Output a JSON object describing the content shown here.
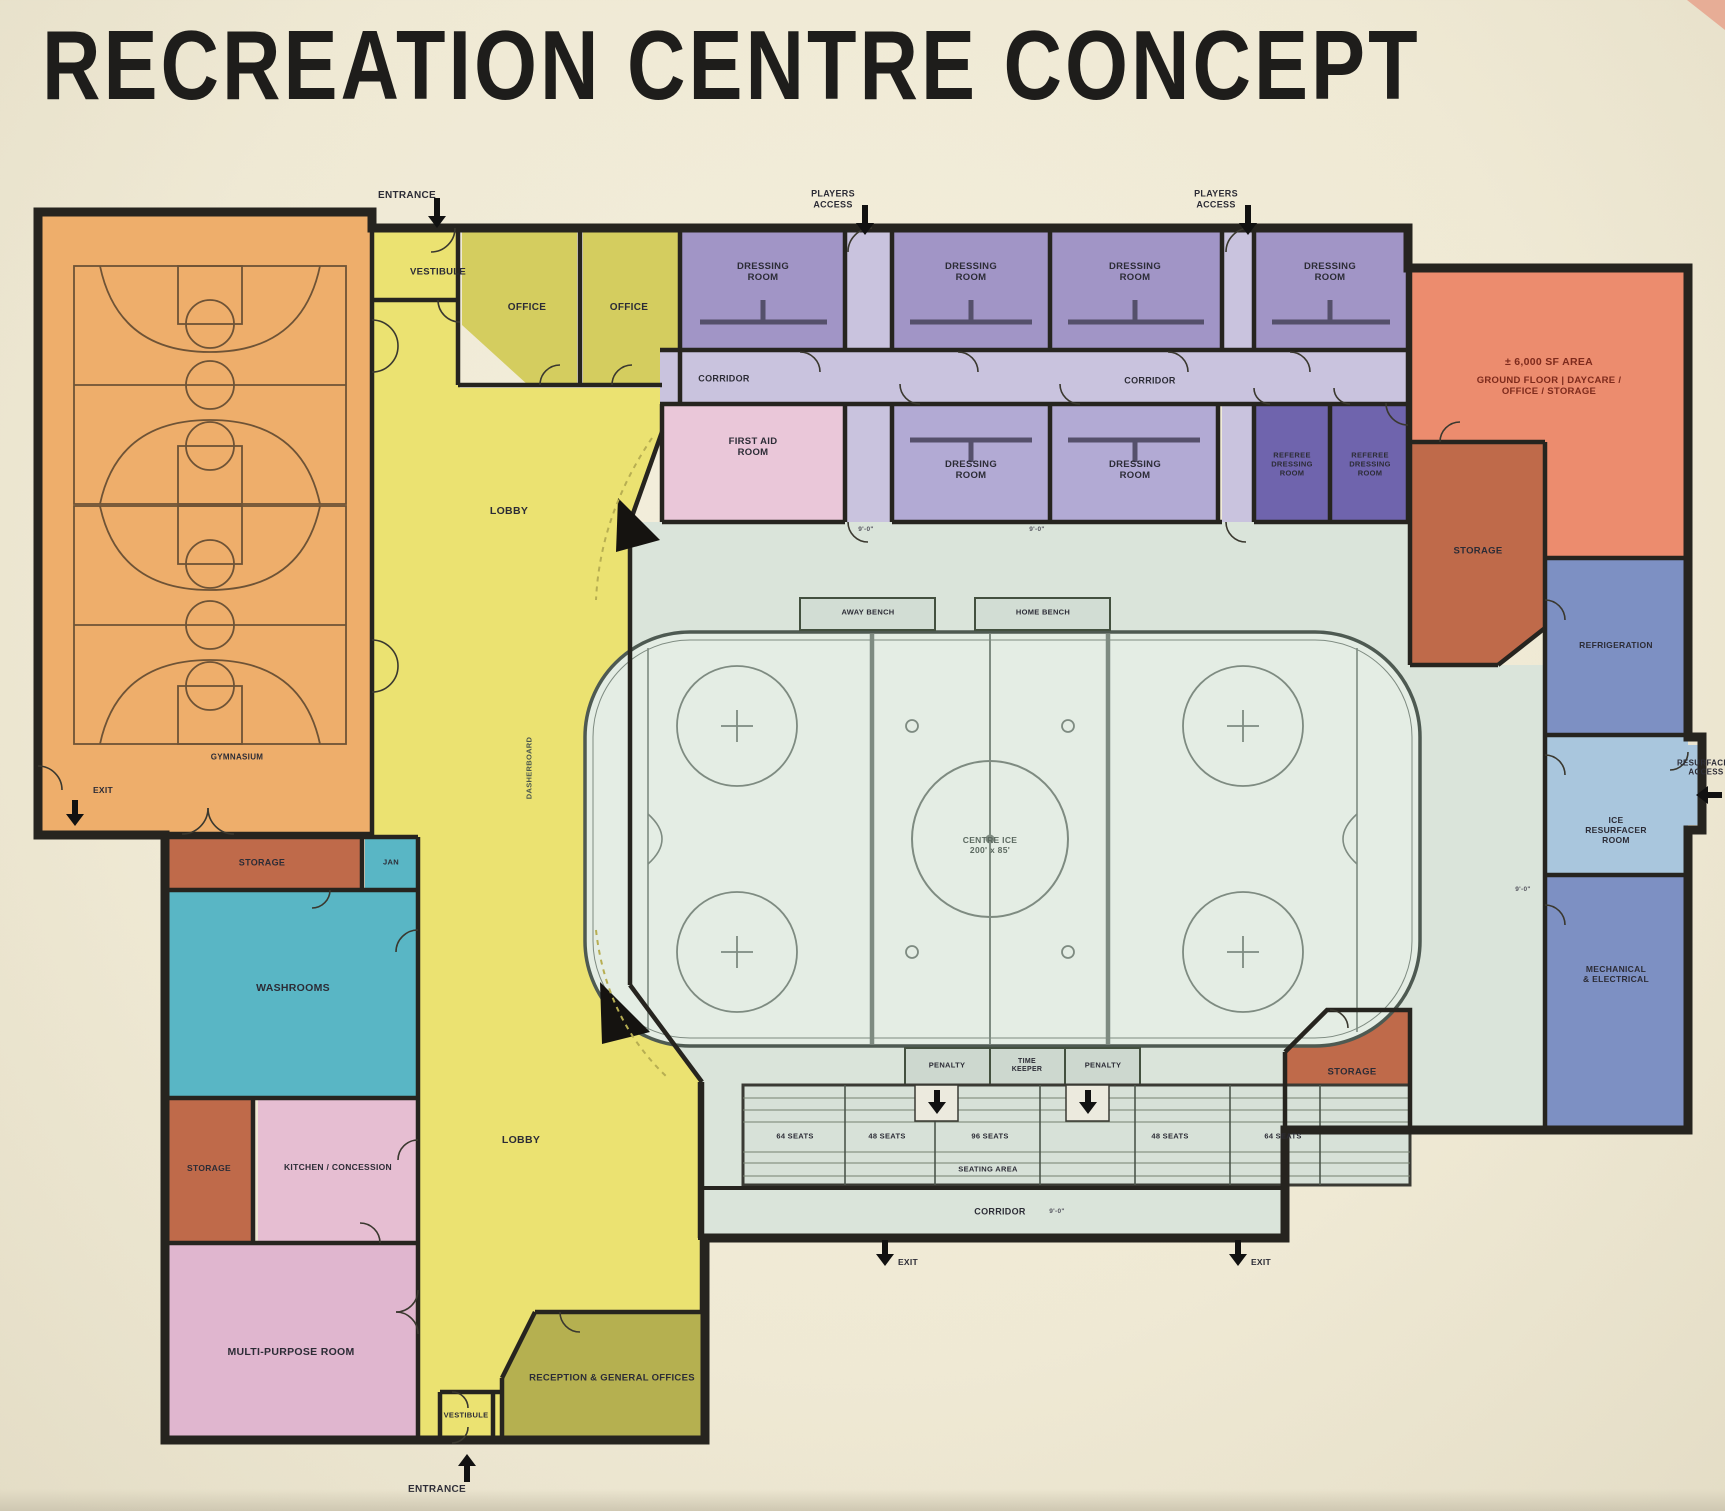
{
  "title": "RECREATION CENTRE CONCEPT",
  "colors": {
    "poster_bg": "#f2edda",
    "walls": "#26241f",
    "gymnasium": "#eeae6b",
    "lobby_yellow": "#ebe271",
    "office_olive": "#d4cd5f",
    "reception_olive": "#b5b050",
    "dressing_purple": "#a195c6",
    "dressing_lavender": "#b2aad4",
    "corridor_lilac": "#c9c3de",
    "referee_purple": "#6f64ad",
    "first_aid_pink": "#eac7d9",
    "upper_area_salmon": "#ec8c6e",
    "storage_sienna": "#bf6a4a",
    "washrooms_teal": "#59b6c5",
    "mechanical_blue": "#7d90c3",
    "resurfacer_blue": "#a9c6dd",
    "concourse_mint": "#dae4da",
    "ice_mint": "#e4ede4",
    "multipurpose_pink": "#e0b6cf",
    "kitchen_pink": "#e6bed2",
    "salmon_text": "#7d2a1c"
  },
  "labels": [
    {
      "name": "label-entrance-top",
      "text": "ENTRANCE",
      "x": 407,
      "y": 196,
      "fs": 10
    },
    {
      "name": "label-vestibule-top",
      "text": "VESTIBULE",
      "x": 438,
      "y": 272,
      "fs": 9.5
    },
    {
      "name": "label-office-1",
      "text": "OFFICE",
      "x": 527,
      "y": 308,
      "fs": 10
    },
    {
      "name": "label-office-2",
      "text": "OFFICE",
      "x": 629,
      "y": 308,
      "fs": 10
    },
    {
      "name": "label-lobby-upper",
      "text": "LOBBY",
      "x": 509,
      "y": 511,
      "fs": 10.5
    },
    {
      "name": "label-dressing-room-1",
      "text": "DRESSING\nROOM",
      "x": 763,
      "y": 272,
      "fs": 9.5
    },
    {
      "name": "label-dressing-room-2",
      "text": "DRESSING\nROOM",
      "x": 971,
      "y": 272,
      "fs": 9.5
    },
    {
      "name": "label-dressing-room-3",
      "text": "DRESSING\nROOM",
      "x": 1135,
      "y": 272,
      "fs": 9.5
    },
    {
      "name": "label-dressing-room-4",
      "text": "DRESSING\nROOM",
      "x": 1330,
      "y": 272,
      "fs": 9.5
    },
    {
      "name": "label-corridor-1",
      "text": "CORRIDOR",
      "x": 724,
      "y": 379,
      "fs": 9
    },
    {
      "name": "label-corridor-2",
      "text": "CORRIDOR",
      "x": 1150,
      "y": 381,
      "fs": 9
    },
    {
      "name": "label-first-aid",
      "text": "FIRST AID\nROOM",
      "x": 753,
      "y": 447,
      "fs": 9.5
    },
    {
      "name": "label-dressing-room-5",
      "text": "DRESSING\nROOM",
      "x": 971,
      "y": 470,
      "fs": 9.5
    },
    {
      "name": "label-dressing-room-6",
      "text": "DRESSING\nROOM",
      "x": 1135,
      "y": 470,
      "fs": 9.5
    },
    {
      "name": "label-referee-room-1",
      "text": "REFEREE\nDRESSING\nROOM",
      "x": 1292,
      "y": 465,
      "fs": 7.5
    },
    {
      "name": "label-referee-room-2",
      "text": "REFEREE\nDRESSING\nROOM",
      "x": 1370,
      "y": 465,
      "fs": 7.5
    },
    {
      "name": "label-upper-area-size",
      "text": "± 6,000 SF AREA",
      "x": 1549,
      "y": 362,
      "fs": 10.5,
      "col": "#7d2a1c"
    },
    {
      "name": "label-upper-area-uses",
      "text": "GROUND FLOOR | DAYCARE / OFFICE / STORAGE",
      "x": 1549,
      "y": 386,
      "fs": 9.5,
      "col": "#7d2a1c"
    },
    {
      "name": "label-storage-ne",
      "text": "STORAGE",
      "x": 1478,
      "y": 551,
      "fs": 9.5
    },
    {
      "name": "label-refrigeration",
      "text": "REFRIGERATION",
      "x": 1616,
      "y": 645,
      "fs": 8.5
    },
    {
      "name": "label-ice-resurfacer-room",
      "text": "ICE\nRESURFACER\nROOM",
      "x": 1616,
      "y": 830,
      "fs": 8.5
    },
    {
      "name": "label-mechanical-electrical",
      "text": "MECHANICAL\n& ELECTRICAL",
      "x": 1616,
      "y": 974,
      "fs": 8.5
    },
    {
      "name": "label-resurfacer-access",
      "text": "RESURFACER\nACCESS",
      "x": 1706,
      "y": 768,
      "fs": 8
    },
    {
      "name": "label-storage-se",
      "text": "STORAGE",
      "x": 1352,
      "y": 1072,
      "fs": 9.5
    },
    {
      "name": "label-storage-strip",
      "text": "STORAGE",
      "x": 262,
      "y": 863,
      "fs": 9
    },
    {
      "name": "label-jan",
      "text": "JAN",
      "x": 391,
      "y": 863,
      "fs": 7.5
    },
    {
      "name": "label-washrooms",
      "text": "WASHROOMS",
      "x": 293,
      "y": 988,
      "fs": 10.5
    },
    {
      "name": "label-storage-w",
      "text": "STORAGE",
      "x": 209,
      "y": 1168,
      "fs": 8.5
    },
    {
      "name": "label-kitchen-concession",
      "text": "KITCHEN / CONCESSION",
      "x": 338,
      "y": 1167,
      "fs": 8.5
    },
    {
      "name": "label-multi-purpose",
      "text": "MULTI-PURPOSE ROOM",
      "x": 291,
      "y": 1352,
      "fs": 10.5
    },
    {
      "name": "label-lobby-lower",
      "text": "LOBBY",
      "x": 521,
      "y": 1140,
      "fs": 10.5
    },
    {
      "name": "label-reception",
      "text": "RECEPTION & GENERAL OFFICES",
      "x": 612,
      "y": 1378,
      "fs": 9.5
    },
    {
      "name": "label-vestibule-bottom",
      "text": "VESTIBULE",
      "x": 466,
      "y": 1416,
      "fs": 7.5
    },
    {
      "name": "label-entrance-bottom",
      "text": "ENTRANCE",
      "x": 437,
      "y": 1490,
      "fs": 10
    },
    {
      "name": "label-players-access-1",
      "text": "PLAYERS\nACCESS",
      "x": 833,
      "y": 199,
      "fs": 9
    },
    {
      "name": "label-players-access-2",
      "text": "PLAYERS\nACCESS",
      "x": 1216,
      "y": 199,
      "fs": 9
    },
    {
      "name": "label-away-bench",
      "text": "AWAY BENCH",
      "x": 868,
      "y": 613,
      "fs": 7.5
    },
    {
      "name": "label-home-bench",
      "text": "HOME BENCH",
      "x": 1043,
      "y": 613,
      "fs": 7.5
    },
    {
      "name": "label-centre-ice",
      "text": "CENTRE ICE\n200' x 85'",
      "x": 990,
      "y": 845,
      "fs": 8.5,
      "col": "#5c6a61"
    },
    {
      "name": "label-penalty-1",
      "text": "PENALTY",
      "x": 947,
      "y": 1066,
      "fs": 7.5
    },
    {
      "name": "label-time-keeper",
      "text": "TIME\nKEEPER",
      "x": 1027,
      "y": 1066,
      "fs": 7
    },
    {
      "name": "label-penalty-2",
      "text": "PENALTY",
      "x": 1103,
      "y": 1066,
      "fs": 7.5
    },
    {
      "name": "label-seats-1",
      "text": "64 SEATS",
      "x": 795,
      "y": 1137,
      "fs": 7.5
    },
    {
      "name": "label-seats-2",
      "text": "48 SEATS",
      "x": 887,
      "y": 1137,
      "fs": 7.5
    },
    {
      "name": "label-seats-3",
      "text": "96 SEATS",
      "x": 990,
      "y": 1137,
      "fs": 7.5
    },
    {
      "name": "label-seats-4",
      "text": "48 SEATS",
      "x": 1170,
      "y": 1137,
      "fs": 7.5
    },
    {
      "name": "label-seats-5",
      "text": "64 SEATS",
      "x": 1283,
      "y": 1137,
      "fs": 7.5
    },
    {
      "name": "label-seating-area",
      "text": "SEATING AREA",
      "x": 988,
      "y": 1170,
      "fs": 7.5
    },
    {
      "name": "label-corridor-3",
      "text": "CORRIDOR",
      "x": 1000,
      "y": 1212,
      "fs": 9
    },
    {
      "name": "label-exit-1",
      "text": "EXIT",
      "x": 908,
      "y": 1262,
      "fs": 8.5
    },
    {
      "name": "label-exit-2",
      "text": "EXIT",
      "x": 1261,
      "y": 1262,
      "fs": 8.5
    },
    {
      "name": "label-exit-3",
      "text": "EXIT",
      "x": 103,
      "y": 790,
      "fs": 8.5
    },
    {
      "name": "label-gymnasium",
      "text": "GYMNASIUM",
      "x": 237,
      "y": 757,
      "fs": 8
    },
    {
      "name": "label-dasherboard",
      "text": "DASHERBOARD",
      "x": 530,
      "y": 768,
      "fs": 7.5,
      "rot": -90,
      "col": "#4c584f"
    },
    {
      "name": "label-dim-1",
      "text": "9'-0\"",
      "x": 866,
      "y": 530,
      "fs": 6.5,
      "col": "#55555f"
    },
    {
      "name": "label-dim-2",
      "text": "9'-0\"",
      "x": 1037,
      "y": 530,
      "fs": 6.5,
      "col": "#55555f"
    },
    {
      "name": "label-dim-3",
      "text": "9'-0\"",
      "x": 1523,
      "y": 890,
      "fs": 6.5,
      "col": "#55555f"
    },
    {
      "name": "label-dim-4",
      "text": "9'-0\"",
      "x": 1057,
      "y": 1212,
      "fs": 6.5,
      "col": "#55555f"
    }
  ]
}
